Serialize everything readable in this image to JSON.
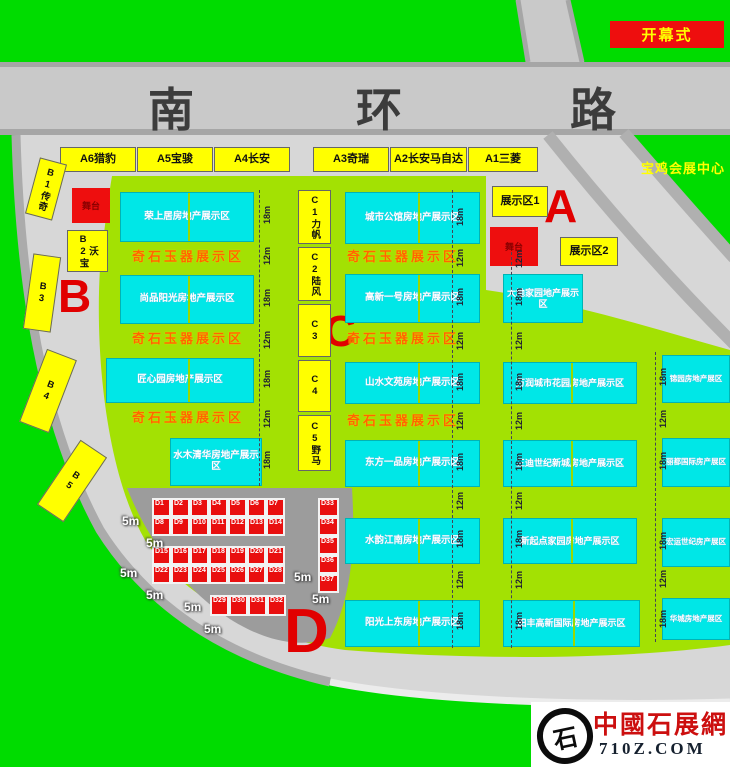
{
  "road": {
    "chars": [
      "南",
      "环",
      "路"
    ]
  },
  "opening_label": "开幕式",
  "venue_center_label": "宝鸡会展中心",
  "zone_letters": {
    "a": "A",
    "b": "B",
    "c": "C",
    "d": "D"
  },
  "stage_label": "舞台",
  "display_zones": [
    "展示区1",
    "展示区2"
  ],
  "a_stalls": [
    "A6猎豹",
    "A5宝骏",
    "A4长安",
    "A3奇瑞",
    "A2长安马自达",
    "A1三菱"
  ],
  "b_stalls": [
    "B1传奇",
    "B2宝沃",
    "B3",
    "B4",
    "B5"
  ],
  "c_stalls": [
    "C1力帆",
    "C2陆风",
    "C3",
    "C4",
    "C5野马"
  ],
  "jade_band_label": "奇石玉器展示区",
  "left_rows": [
    "荣上居房地产展示区",
    "尚品阳光房地产展示区",
    "匠心园房地产展示区",
    "水木清华房地产展示区"
  ],
  "mid_rows": [
    "城市公馆房地产展示区",
    "高新一号房地产展示区",
    "山水文苑房地产展示区",
    "东方一品房地产展示区",
    "水韵江南房地产展示区",
    "阳光上东房地产展示区"
  ],
  "right_rows": [
    "大地家园地产展示区",
    "万润城市花园房地产展示区",
    "三迪世纪新城房地产展示区",
    "新起点家园房地产展示区",
    "田丰高新国际房地产展示区"
  ],
  "far_right_rows": [
    "锦园房地产展区",
    "丽都国际房产展区",
    "宏运世纪房产展区",
    "华城房地产展区"
  ],
  "measures": {
    "m18": "18m",
    "m12": "12m",
    "m5": "5m"
  },
  "d_cells": [
    "D1",
    "D2",
    "D3",
    "D4",
    "D5",
    "D6",
    "D7",
    "D8",
    "D9",
    "D10",
    "D11",
    "D12",
    "D13",
    "D14",
    "D15",
    "D16",
    "D17",
    "D18",
    "D19",
    "D20",
    "D21",
    "D22",
    "D23",
    "D24",
    "D25",
    "D26",
    "D27",
    "D28",
    "D29",
    "D30",
    "D31",
    "D32",
    "D33",
    "D34",
    "D35",
    "D36",
    "D37"
  ],
  "logo": {
    "glyph": "石",
    "title": "中國石展網",
    "domain": "710Z.COM"
  },
  "colors": {
    "outside_green": "#00dc00",
    "venue_green": "#a3e103",
    "booth_cyan": "#00e7e7",
    "stall_yellow": "#ffff00",
    "accent_red": "#ee0e0e",
    "band_orange": "#ff6600",
    "road_gray": "#c9c9c9",
    "plaza_gray": "#9c9c9c"
  }
}
